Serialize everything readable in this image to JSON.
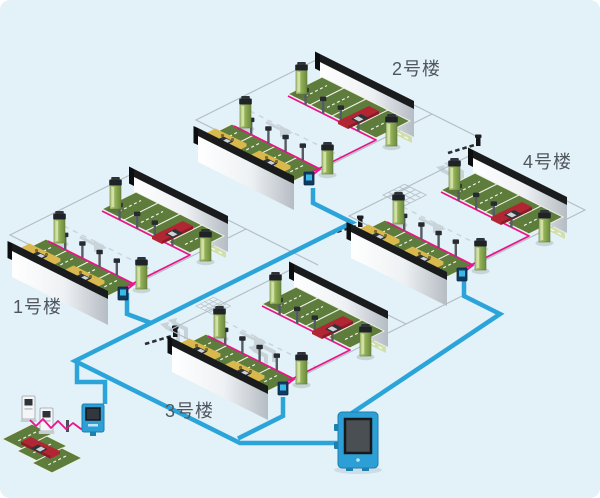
{
  "buildings": [
    {
      "id": "building-1",
      "label": "1号楼"
    },
    {
      "id": "building-2",
      "label": "2号楼"
    },
    {
      "id": "building-3",
      "label": "3号楼"
    },
    {
      "id": "building-4",
      "label": "4号楼"
    }
  ],
  "colors": {
    "background": "#e3f1f8",
    "network_line": "#2ba4d9",
    "charging_cable": "#e8158c",
    "parking_green": "#5e7c3c",
    "pillar_green": "#8fae55",
    "wall_dark": "#1a1b1d",
    "car_red": "#b22532",
    "car_yellow": "#d9b84e",
    "controller_blue": "#2b9fd6",
    "label_text": "#50565c",
    "road_line": "#b2bcc4",
    "decor_gray": "#c8d2d9"
  },
  "icons": {
    "junction_box": "small navy box with cyan screen at each lot corner",
    "central_controller": "blue wall-mount controller with dark screen",
    "payment_kiosk": "blue curbside kiosk with screen",
    "charging_station": "white charging cabinet with dark screen",
    "charging_pillar": "green pillar with dark cap",
    "charging_post": "gray post with dark head",
    "gate_barrier": "dashed arm with end post",
    "road_crosshatch": "isometric grid square road marking",
    "fork_arrow": "light gray double fork lane arrow",
    "lane_arrow": "light gray straight lane arrow"
  }
}
